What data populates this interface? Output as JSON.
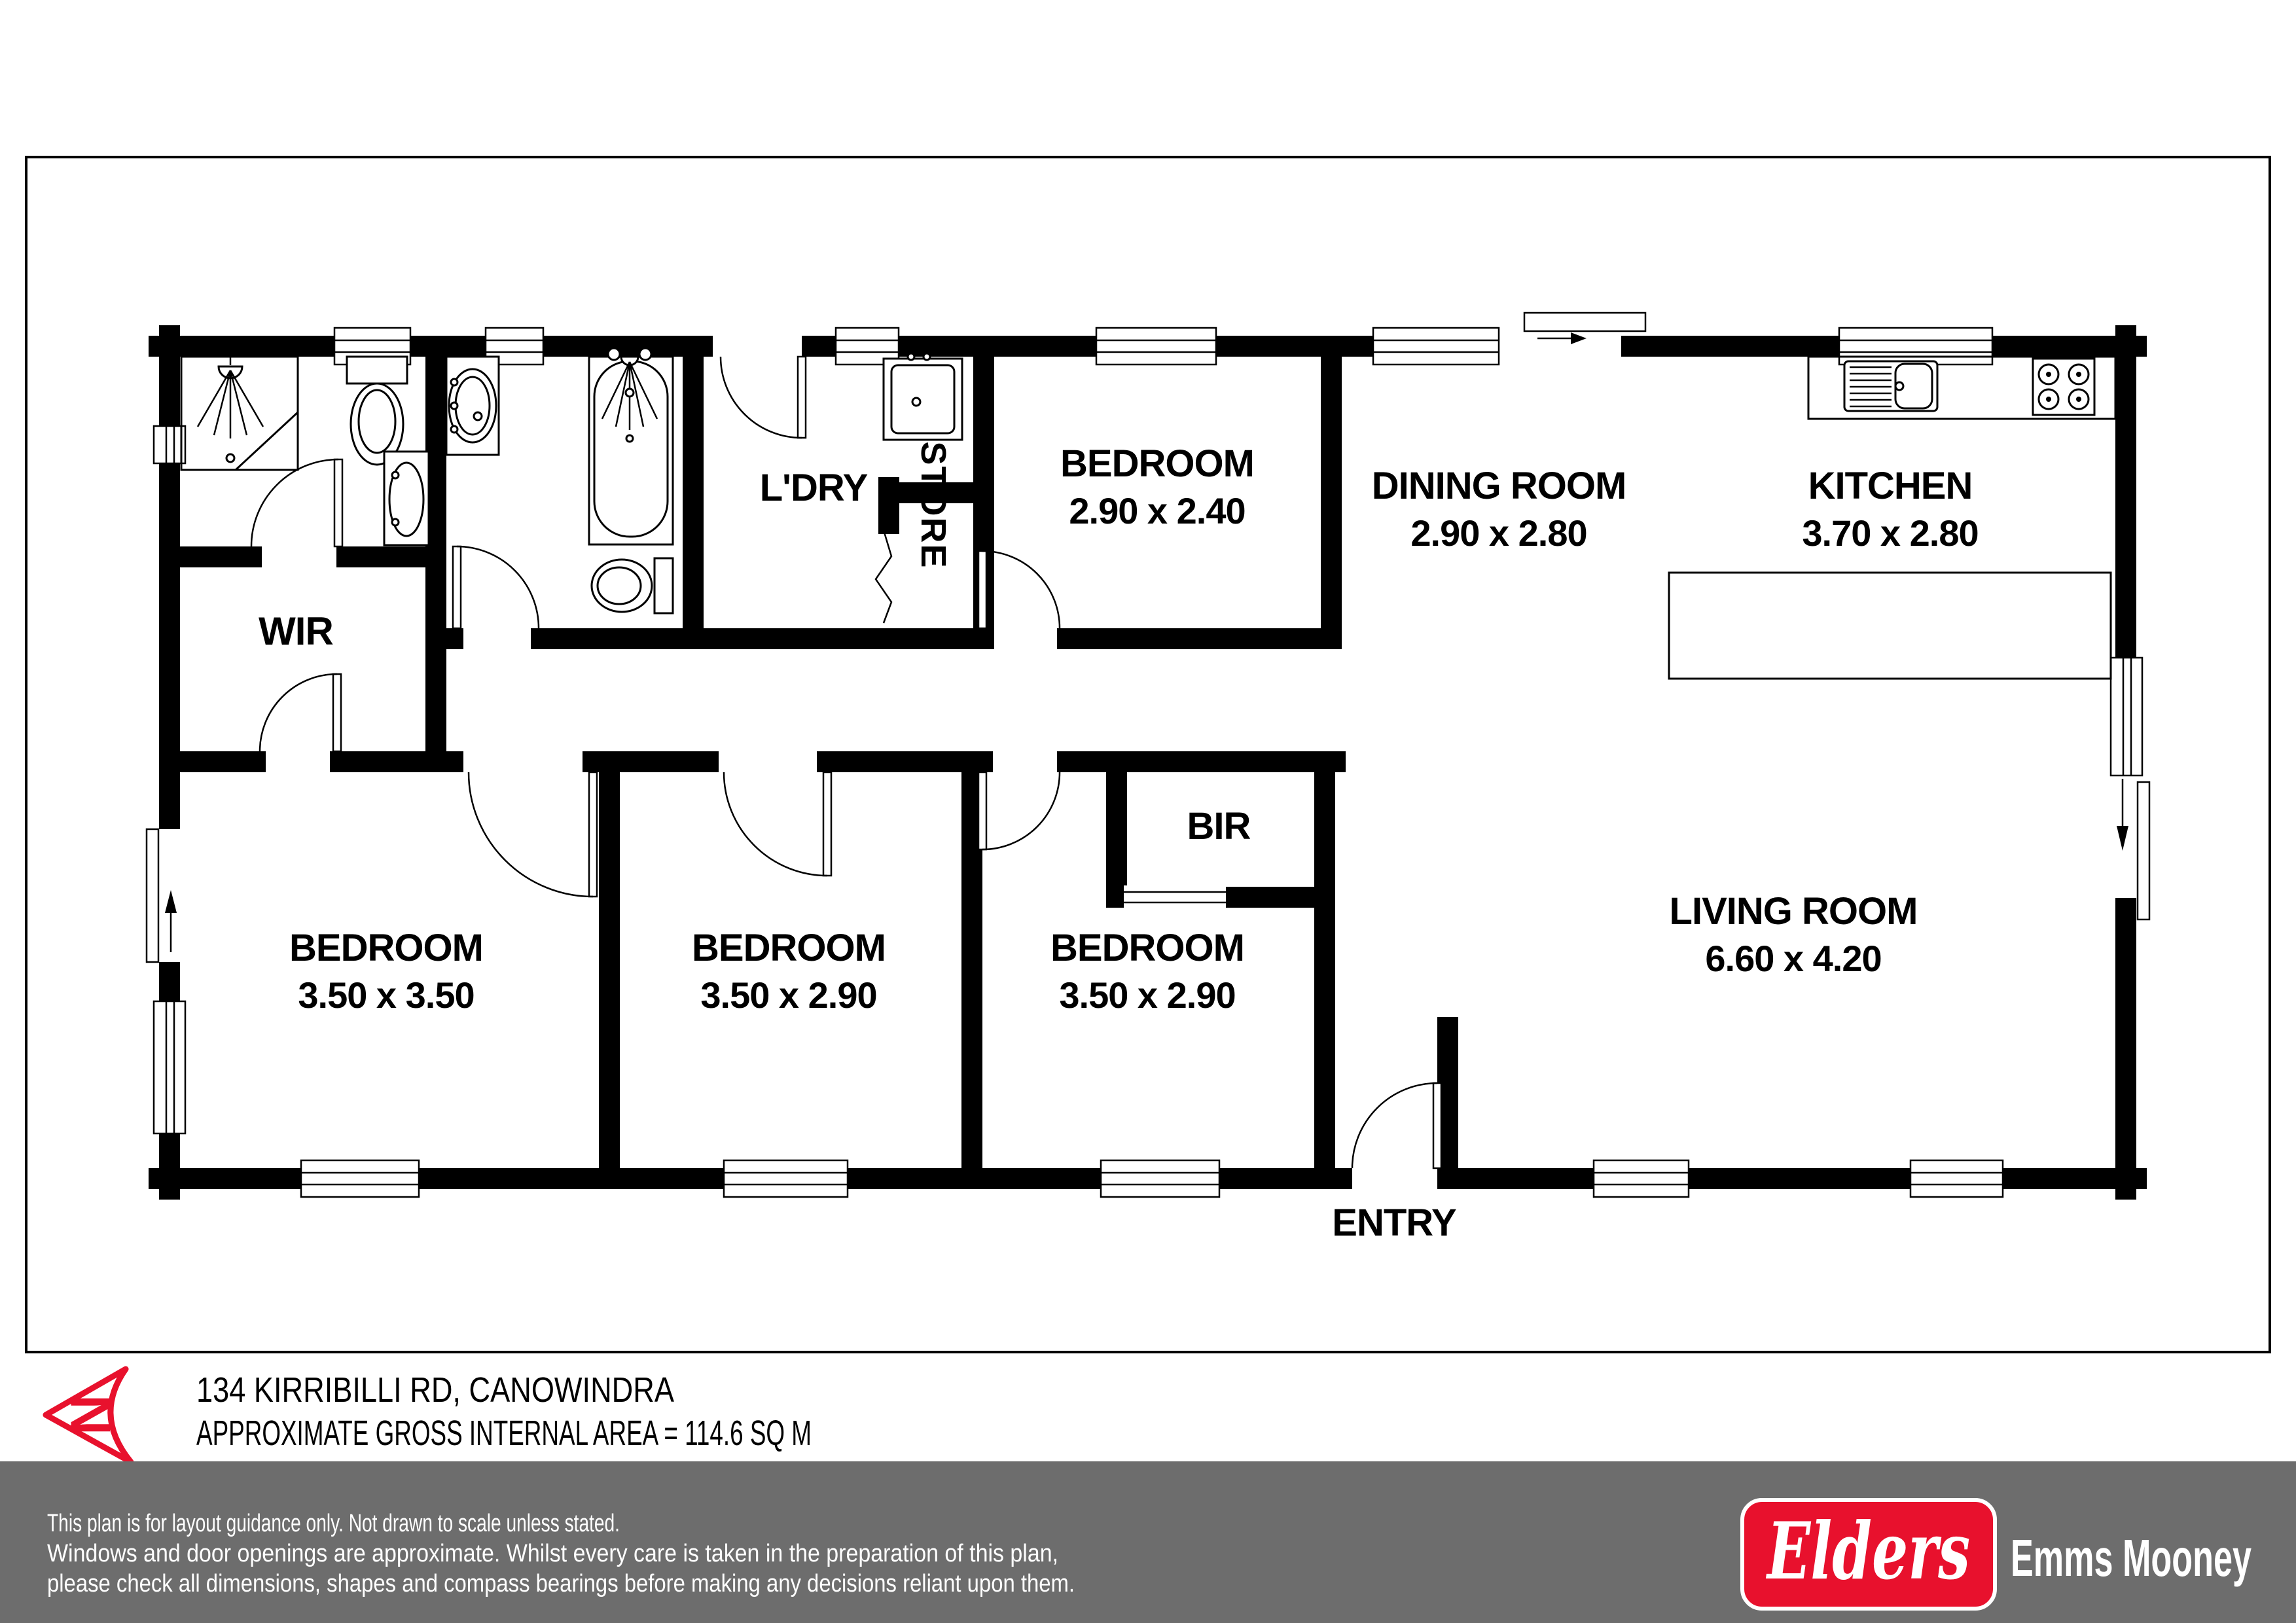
{
  "floorplan": {
    "rooms": {
      "ldry": {
        "label": "L'DRY"
      },
      "store": {
        "label": "STORE"
      },
      "wir": {
        "label": "WIR"
      },
      "bir": {
        "label": "BIR"
      },
      "bed_top": {
        "label": "BEDROOM",
        "dims": "2.90 x 2.40"
      },
      "dining": {
        "label": "DINING ROOM",
        "dims": "2.90 x 2.80"
      },
      "kitchen": {
        "label": "KITCHEN",
        "dims": "3.70 x 2.80"
      },
      "bed1": {
        "label": "BEDROOM",
        "dims": "3.50 x 3.50"
      },
      "bed2": {
        "label": "BEDROOM",
        "dims": "3.50 x 2.90"
      },
      "bed3": {
        "label": "BEDROOM",
        "dims": "3.50 x 2.90"
      },
      "living": {
        "label": "LIVING ROOM",
        "dims": "6.60 x 4.20"
      },
      "entry": {
        "label": "ENTRY"
      }
    },
    "north_letter": "N",
    "address": "134 KIRRIBILLI RD, CANOWINDRA",
    "area": "APPROXIMATE GROSS INTERNAL AREA = 114.6 SQ M"
  },
  "footer": {
    "disclaimer": [
      "This plan is for layout guidance only. Not drawn to scale unless stated.",
      "Windows and door openings are approximate. Whilst every care is taken in the preparation of this plan,",
      "please check all dimensions, shapes and compass bearings before making any decisions reliant upon them."
    ],
    "logo_text": "Elders",
    "agency": "Emms Mooney"
  },
  "colors": {
    "brand_red": "#e8112d",
    "footer_gray": "#6d6d6d",
    "line_black": "#000000"
  }
}
